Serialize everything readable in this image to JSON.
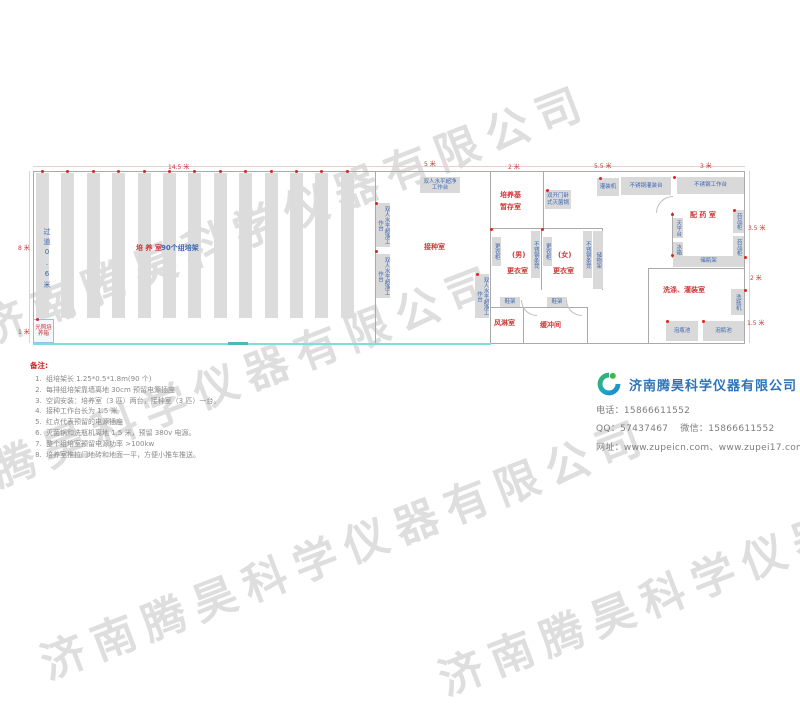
{
  "watermark": {
    "text": "济南腾昊科学仪器有限公司",
    "instances": [
      {
        "x": -30,
        "y": 298,
        "a": -21
      },
      {
        "x": -120,
        "y": 478,
        "a": -21
      },
      {
        "x": 30,
        "y": 632,
        "a": -21
      },
      {
        "x": 428,
        "y": 648,
        "a": -21
      }
    ]
  },
  "plan": {
    "walls": [
      {
        "x": 33,
        "y": 166,
        "w": 712,
        "h": 1,
        "c": "dimline"
      },
      {
        "x": 29,
        "y": 171,
        "w": 1,
        "h": 172,
        "c": "dimline"
      },
      {
        "x": 749,
        "y": 171,
        "w": 1,
        "h": 172,
        "c": "dimline"
      },
      {
        "x": 33,
        "y": 171,
        "w": 712,
        "h": 1
      },
      {
        "x": 33,
        "y": 171,
        "w": 1,
        "h": 172
      },
      {
        "x": 744,
        "y": 171,
        "w": 1,
        "h": 172
      },
      {
        "x": 490,
        "y": 343,
        "w": 255,
        "h": 1
      },
      {
        "x": 33,
        "y": 343,
        "w": 458,
        "h": 2,
        "c": "cyan"
      },
      {
        "x": 228,
        "y": 342,
        "w": 20,
        "h": 3,
        "c": "teal"
      },
      {
        "x": 375,
        "y": 171,
        "w": 1,
        "h": 172
      },
      {
        "x": 490,
        "y": 171,
        "w": 1,
        "h": 172
      },
      {
        "x": 543,
        "y": 171,
        "w": 1,
        "h": 58
      },
      {
        "x": 490,
        "y": 228,
        "w": 113,
        "h": 1
      },
      {
        "x": 541,
        "y": 228,
        "w": 1,
        "h": 62
      },
      {
        "x": 602,
        "y": 228,
        "w": 1,
        "h": 62
      },
      {
        "x": 490,
        "y": 307,
        "w": 97,
        "h": 1
      },
      {
        "x": 523,
        "y": 307,
        "w": 1,
        "h": 36
      },
      {
        "x": 587,
        "y": 307,
        "w": 1,
        "h": 36
      },
      {
        "x": 672,
        "y": 212,
        "w": 1,
        "h": 46
      },
      {
        "x": 648,
        "y": 268,
        "w": 97,
        "h": 1
      },
      {
        "x": 648,
        "y": 268,
        "w": 1,
        "h": 75
      }
    ],
    "racks": {
      "count": 13,
      "x0": 36,
      "pitch": 25.4,
      "width": 13,
      "y": 173,
      "height": 145
    },
    "equipment": [
      {
        "n": "laminar-bench",
        "t": "双人水平超净工作台",
        "x": 420,
        "y": 177,
        "w": 40,
        "h": 16
      },
      {
        "n": "laminar-bench",
        "t": "双人水平超净工作台",
        "x": 376,
        "y": 203,
        "w": 14,
        "h": 44,
        "v": 1
      },
      {
        "n": "laminar-bench",
        "t": "双人水平超净工作台",
        "x": 376,
        "y": 254,
        "w": 14,
        "h": 44,
        "v": 1
      },
      {
        "n": "laminar-bench",
        "t": "双人水平超净工作台",
        "x": 475,
        "y": 274,
        "w": 14,
        "h": 44,
        "v": 1
      },
      {
        "n": "sterilizer",
        "t": "双开门卧式灭菌锅",
        "x": 545,
        "y": 190,
        "w": 26,
        "h": 19
      },
      {
        "n": "filling-machine",
        "t": "灌装机",
        "x": 597,
        "y": 178,
        "w": 22,
        "h": 18
      },
      {
        "n": "filling-table",
        "t": "不锈钢灌装台",
        "x": 621,
        "y": 177,
        "w": 50,
        "h": 18
      },
      {
        "n": "work-table",
        "t": "不锈钢工作台",
        "x": 677,
        "y": 177,
        "w": 67,
        "h": 17
      },
      {
        "n": "medicine-cabinet",
        "t": "药品柜",
        "x": 733,
        "y": 210,
        "w": 11,
        "h": 23,
        "v": 1
      },
      {
        "n": "medicine-cabinet",
        "t": "药品柜",
        "x": 733,
        "y": 236,
        "w": 11,
        "h": 23,
        "v": 1
      },
      {
        "n": "balance-table",
        "t": "天平台",
        "x": 673,
        "y": 218,
        "w": 10,
        "h": 20,
        "v": 1
      },
      {
        "n": "fridge",
        "t": "冰箱",
        "x": 673,
        "y": 242,
        "w": 10,
        "h": 15,
        "v": 1
      },
      {
        "n": "bottle-rack",
        "t": "储瓶架",
        "x": 673,
        "y": 256,
        "w": 71,
        "h": 11
      },
      {
        "n": "bottle-washer",
        "t": "洗瓶机",
        "x": 731,
        "y": 289,
        "w": 13,
        "h": 26,
        "v": 1
      },
      {
        "n": "soak-pool",
        "t": "泡瓶池",
        "x": 666,
        "y": 321,
        "w": 32,
        "h": 20
      },
      {
        "n": "soak-pool",
        "t": "泡瓶池",
        "x": 703,
        "y": 321,
        "w": 41,
        "h": 20
      },
      {
        "n": "locker",
        "t": "更衣柜",
        "x": 492,
        "y": 237,
        "w": 9,
        "h": 29,
        "v": 1
      },
      {
        "n": "steel-bench",
        "t": "不锈钢条凳",
        "x": 531,
        "y": 231,
        "w": 9,
        "h": 47,
        "v": 1
      },
      {
        "n": "locker",
        "t": "更衣柜",
        "x": 543,
        "y": 237,
        "w": 9,
        "h": 29,
        "v": 1
      },
      {
        "n": "steel-bench",
        "t": "不锈钢条凳",
        "x": 583,
        "y": 231,
        "w": 9,
        "h": 47,
        "v": 1
      },
      {
        "n": "storage-rack",
        "t": "储物架",
        "x": 593,
        "y": 231,
        "w": 10,
        "h": 58,
        "v": 1
      },
      {
        "n": "shoe-rack",
        "t": "鞋架",
        "x": 500,
        "y": 297,
        "w": 20,
        "h": 10
      },
      {
        "n": "shoe-rack",
        "t": "鞋架",
        "x": 547,
        "y": 297,
        "w": 20,
        "h": 10
      },
      {
        "n": "light-incubator",
        "t": "光照培养箱",
        "x": 33,
        "y": 319,
        "w": 21,
        "h": 24,
        "cls": "lightbox"
      }
    ],
    "room_labels": [
      {
        "t": "培 养 室",
        "x": 136,
        "y": 243
      },
      {
        "t": "接种室",
        "x": 424,
        "y": 242
      },
      {
        "t": "培养基",
        "x": 500,
        "y": 190
      },
      {
        "t": "暂存室",
        "x": 500,
        "y": 202
      },
      {
        "t": "(男)",
        "x": 512,
        "y": 250
      },
      {
        "t": "更衣室",
        "x": 507,
        "y": 266
      },
      {
        "t": "(女)",
        "x": 558,
        "y": 250
      },
      {
        "t": "更衣室",
        "x": 553,
        "y": 266
      },
      {
        "t": "风淋室",
        "x": 494,
        "y": 318
      },
      {
        "t": "缓冲间",
        "x": 540,
        "y": 320
      },
      {
        "t": "配 药 室",
        "x": 690,
        "y": 210
      },
      {
        "t": "洗涤、灌装室",
        "x": 663,
        "y": 285
      }
    ],
    "blue_labels": [
      {
        "t": "90个组培架",
        "x": 161,
        "y": 243
      },
      {
        "t": "过道0.6米",
        "x": 42,
        "y": 228,
        "v": 1
      }
    ],
    "dimensions": [
      {
        "t": "14.5 米",
        "x": 168,
        "y": 162
      },
      {
        "t": "5 米",
        "x": 424,
        "y": 159
      },
      {
        "t": "2 米",
        "x": 508,
        "y": 162
      },
      {
        "t": "5.5 米",
        "x": 594,
        "y": 161
      },
      {
        "t": "3 米",
        "x": 700,
        "y": 161
      },
      {
        "t": "8 米",
        "x": 18,
        "y": 243
      },
      {
        "t": "1 米",
        "x": 18,
        "y": 327
      },
      {
        "t": "3.5 米",
        "x": 748,
        "y": 223
      },
      {
        "t": "2 米",
        "x": 750,
        "y": 273
      },
      {
        "t": "1.5 米",
        "x": 747,
        "y": 318
      }
    ],
    "dots": [
      {
        "x": 546,
        "y": 189
      },
      {
        "x": 599,
        "y": 177
      },
      {
        "x": 673,
        "y": 176
      },
      {
        "x": 733,
        "y": 209
      },
      {
        "x": 671,
        "y": 213
      },
      {
        "x": 671,
        "y": 254
      },
      {
        "x": 744,
        "y": 289
      },
      {
        "x": 666,
        "y": 320
      },
      {
        "x": 702,
        "y": 320
      },
      {
        "x": 490,
        "y": 228
      },
      {
        "x": 541,
        "y": 228
      },
      {
        "x": 375,
        "y": 202
      },
      {
        "x": 375,
        "y": 250
      },
      {
        "x": 476,
        "y": 273
      },
      {
        "x": 36,
        "y": 318
      },
      {
        "x": 744,
        "y": 256
      }
    ],
    "arcs": [
      {
        "x": 521,
        "y": 300,
        "s": 15,
        "o": "bl"
      },
      {
        "x": 566,
        "y": 300,
        "s": 15,
        "o": "bl"
      },
      {
        "x": 656,
        "y": 196,
        "s": 16,
        "o": "tl"
      }
    ]
  },
  "notes": {
    "title": "备注:",
    "items": [
      "组培架长 1.25*0.5*1.8m(90 个)",
      "每排组培架靠墙离地 30cm 预留电源插座",
      "空调安装：培养室（3 匹）两台，接种室（3 匹）一台。",
      "接种工作台长为 1.5 米",
      "红点代表预留的电源插座",
      "灭菌锅和洗瓶机离地 1.5 米，预留 380v 电源。",
      "整个组培室预留电源功率 >100kw",
      "培养室推拉门地砖和地面一平，方便小推车推送。"
    ]
  },
  "company": {
    "name": "济南腾昊科学仪器有限公司",
    "phone_label": "电话：",
    "phone": "15866611552",
    "qq_label": "QQ：",
    "qq": "57437467",
    "wechat_label": "微信：",
    "wechat": "15866611552",
    "web_label": "网址：",
    "web1": "www.zupeicn.com",
    "web_sep": "、",
    "web2": "www.zupei17.com"
  }
}
